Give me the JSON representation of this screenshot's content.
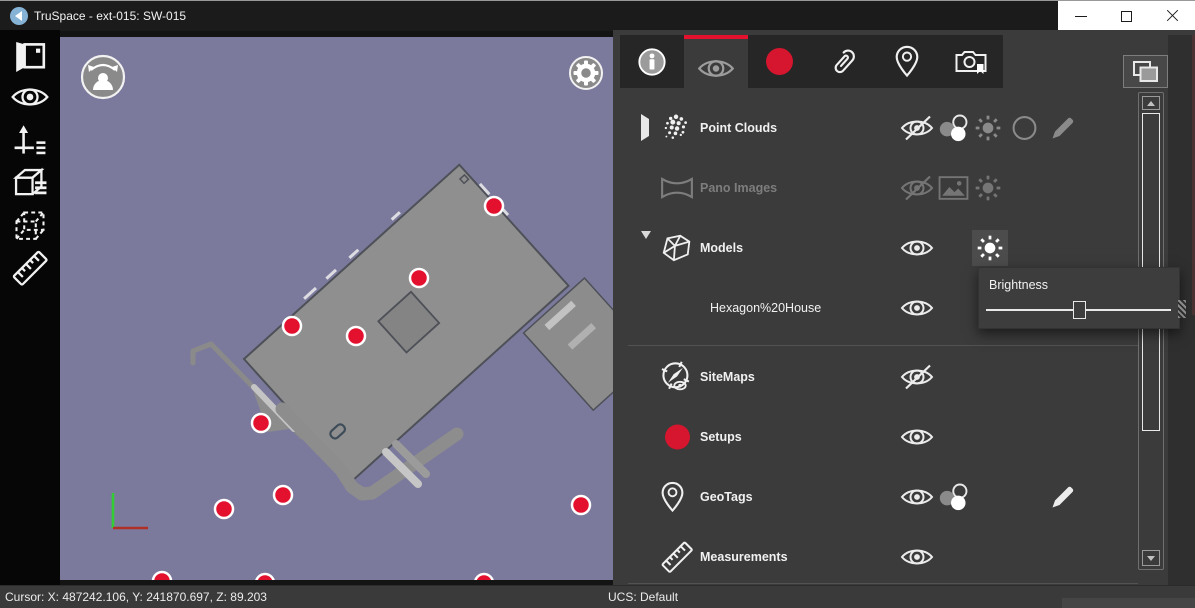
{
  "window": {
    "title": "TruSpace - ext-015: SW-015",
    "app_icon": "truspace-chevron-icon",
    "controls": [
      "minimize-icon",
      "maximize-icon",
      "close-icon"
    ]
  },
  "left_toolbar": {
    "items": [
      {
        "icon": "project-pano-view-icon"
      },
      {
        "icon": "visibility-eye-icon"
      },
      {
        "icon": "move-axes-list-icon"
      },
      {
        "icon": "cube-views-list-icon"
      },
      {
        "icon": "clipping-box-icon"
      },
      {
        "icon": "measure-ruler-icon"
      }
    ]
  },
  "viewport": {
    "background_color": "#7b7a9c",
    "building_color": "#8f8f8f",
    "setup_color": "#e3102e",
    "controls": [
      {
        "icon": "walk-orbit-avatar-icon"
      },
      {
        "icon": "settings-gear-icon"
      }
    ],
    "setups": [
      [
        434,
        169
      ],
      [
        359,
        241
      ],
      [
        232,
        289
      ],
      [
        296,
        299
      ],
      [
        201,
        386
      ],
      [
        223,
        458
      ],
      [
        164,
        472
      ],
      [
        521,
        468
      ],
      [
        102,
        544
      ],
      [
        205,
        546
      ],
      [
        424,
        546
      ]
    ]
  },
  "panel": {
    "accent_color": "#e3102e",
    "tabs": [
      {
        "icon": "info-icon",
        "active": false
      },
      {
        "icon": "visibility-eye-icon",
        "active": true
      },
      {
        "icon": "setups-circle-icon",
        "active": false
      },
      {
        "icon": "annotations-paperclip-icon",
        "active": false
      },
      {
        "icon": "geotags-pin-icon",
        "active": false
      },
      {
        "icon": "snapshots-camera-icon",
        "active": false
      }
    ],
    "panel_toggle_icon": "layout-panels-icon",
    "rows": [
      {
        "label": "Point Clouds",
        "expand": "collapsed",
        "actions": [
          "eye-hidden-icon",
          "appearance-circles-icon",
          "brightness-sun-icon",
          "circle-outline-icon",
          "edit-pencil-icon"
        ]
      },
      {
        "label": "Pano Images",
        "disabled": true,
        "actions": [
          "eye-hidden-icon",
          "image-icon",
          "brightness-sun-icon"
        ]
      },
      {
        "label": "Models",
        "expand": "expanded",
        "actions": [
          "eye-visible-icon",
          "brightness-sun-icon"
        ]
      },
      {
        "label": "Hexagon%20House",
        "child_of": "Models",
        "actions": [
          "eye-visible-icon"
        ]
      },
      {
        "label": "SiteMaps",
        "actions": [
          "eye-hidden-icon"
        ]
      },
      {
        "label": "Setups",
        "actions": [
          "eye-visible-icon"
        ]
      },
      {
        "label": "GeoTags",
        "actions": [
          "eye-visible-icon",
          "appearance-circles-icon",
          "edit-pencil-icon"
        ]
      },
      {
        "label": "Measurements",
        "actions": [
          "eye-visible-icon"
        ]
      }
    ],
    "brightness_popup": {
      "label": "Brightness",
      "value_percent": 51
    }
  },
  "status_bar": {
    "cursor_text": "Cursor: X: 487242.106, Y: 241870.697, Z: 89.203",
    "ucs_text": "UCS: Default"
  }
}
